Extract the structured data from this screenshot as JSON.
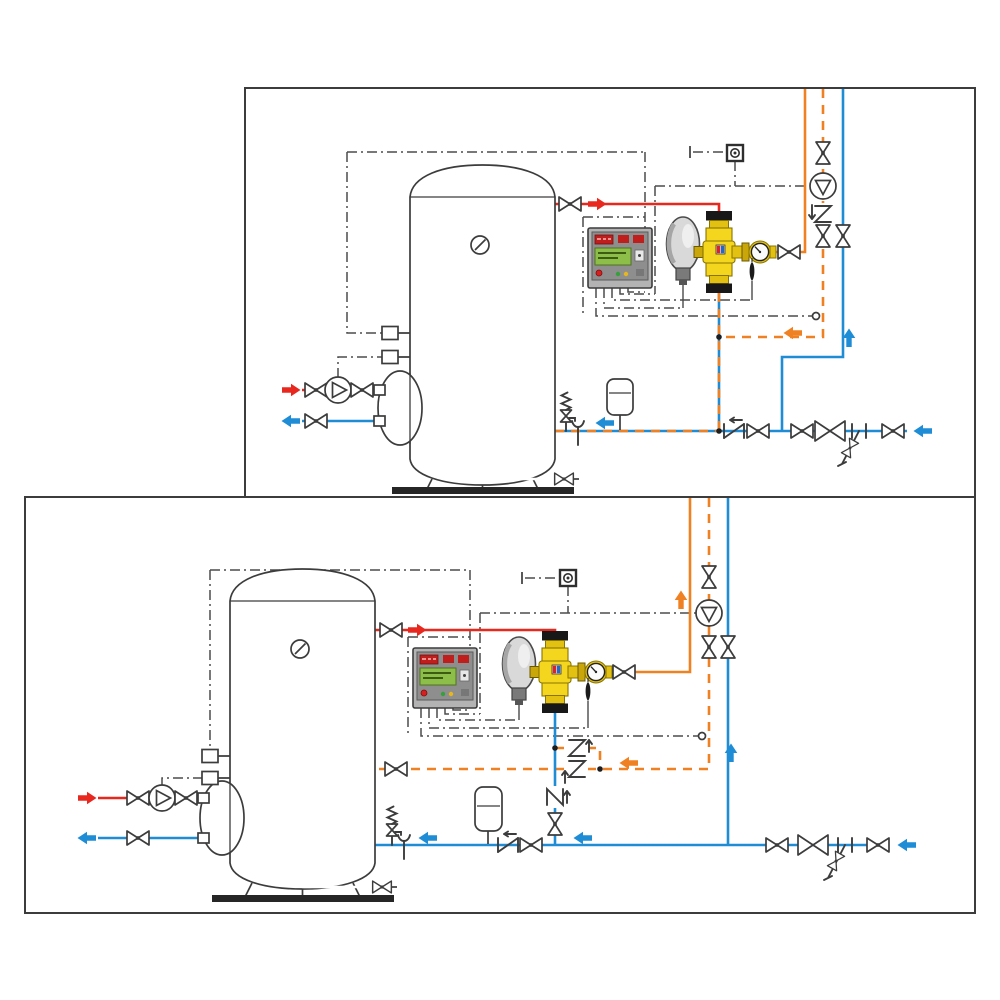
{
  "title": "",
  "colors": {
    "bg": "#ffffff",
    "hot": "#e8281e",
    "cold": "#1f8cd6",
    "mixed": "#f08122",
    "line": "#3c3c3c",
    "dashdot": "#4c4c4c",
    "brass": "#f4d61f",
    "brassdark": "#c9a70b",
    "band": "#181818",
    "actuator": "#d9d9d9",
    "ctrlbody": "#b3b3b3",
    "ctrlpanel": "#8e8e8e",
    "lcd": "#8cbe49",
    "displayred": "#c01d1d",
    "ledred": "#d81f1f",
    "ledgreen": "#35a03c",
    "ledamber": "#e6b71e",
    "base": "#262626"
  },
  "diagram": {
    "type": "hydraulic-installation-schematic",
    "panels": [
      {
        "id": "top",
        "name": "installation-scheme-1",
        "components": [
          "storage-water-heater-tank",
          "tank-thermometer",
          "heat-exchanger-flange",
          "primary-hot-supply",
          "primary-return",
          "primary-circulation-pump",
          "shut-off-ball-valves",
          "digital-mixing-controller",
          "electrothermal-actuator",
          "three-way-mixing-valve",
          "temperature-gauge",
          "immersion-temperature-probe",
          "tank-temperature-sensors",
          "ambient-sensor",
          "recirculation-pump",
          "check-valve",
          "recirculation-temperature-sensor",
          "safety-relief-valve",
          "tundish-drain",
          "expansion-vessel",
          "tank-drain-valve",
          "balancing-valve",
          "drain-cock",
          "mixed-water-riser",
          "recirculation-return-riser",
          "cold-water-inlet"
        ],
        "flows": {
          "hot": "red",
          "cold": "blue",
          "mixed_and_recirculation": "orange-dashed-on-blue"
        }
      },
      {
        "id": "bottom",
        "name": "installation-scheme-2",
        "components": [
          "storage-water-heater-tank",
          "tank-thermometer",
          "heat-exchanger-flange",
          "primary-hot-supply",
          "primary-return",
          "primary-circulation-pump",
          "shut-off-ball-valves",
          "digital-mixing-controller",
          "electrothermal-actuator",
          "three-way-mixing-valve",
          "temperature-gauge",
          "immersion-temperature-probe",
          "tank-temperature-sensors",
          "ambient-sensor",
          "recirculation-pump",
          "bypass-check-valves",
          "recirculation-return-to-tank",
          "vertical-check-valve",
          "recirculation-temperature-sensor",
          "safety-relief-valve",
          "tundish-drain",
          "expansion-vessel",
          "tank-drain-valve",
          "balancing-valve",
          "drain-cock",
          "mixed-water-riser",
          "recirculation-riser",
          "cold-water-inlet"
        ],
        "flows": {
          "hot": "red",
          "cold": "blue",
          "mixed": "orange",
          "recirculation": "orange-dashed"
        }
      }
    ]
  }
}
